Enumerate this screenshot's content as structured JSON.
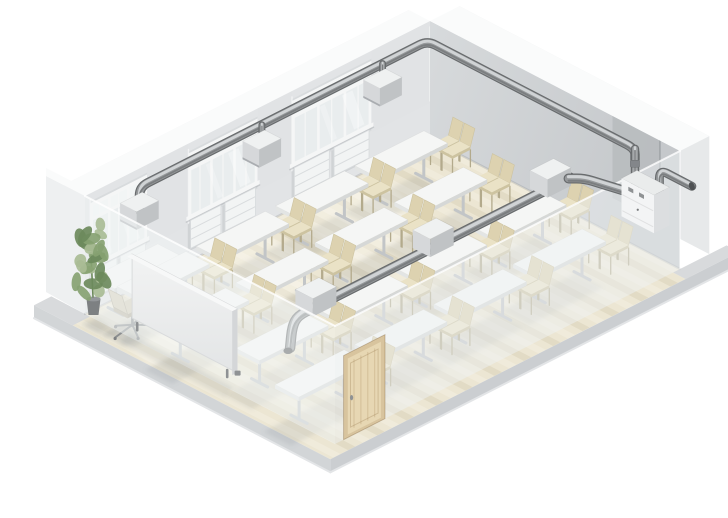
{
  "scene": {
    "description": "3D cutaway illustration of a classroom with a mechanical ventilation system: perimeter supply duct at ceiling level with drop diffusers above the windows, a mid-height extract duct with inline diffuser boxes crossing the room, and a wall-mounted ventilation unit with a pipe stub through the outside wall",
    "room": {
      "window_groups": 3,
      "windows_per_group": 3,
      "radiator_panels": 6
    },
    "ventilation": {
      "ceiling_drop_diffusers": 3,
      "inline_duct_diffusers": 3,
      "wall_units": 1,
      "outdoor_pipe_stubs": 1
    },
    "furniture": {
      "student_tables": 16,
      "student_chairs": 32,
      "teacher_desks": 1,
      "office_chairs": 1,
      "whiteboards": 1,
      "doors": 1,
      "plants": 1
    },
    "layout": {
      "table_rows_a": [
        0.09,
        0.32,
        0.55,
        0.78
      ],
      "table_cols_b": [
        0.1,
        0.32,
        0.575,
        0.795
      ],
      "stagger": 0.045,
      "window_groups_a": [
        [
          0.17,
          0.4
        ],
        [
          0.5,
          0.7
        ],
        [
          0.82,
          0.985
        ]
      ],
      "ceiling_diffusers_a": [
        0.875,
        0.52,
        0.17
      ],
      "inline_diffusers_a": [
        0.78,
        0.44,
        0.1
      ]
    }
  },
  "palette": {
    "background": "#ffffff",
    "floor": "#ece6d3",
    "floor_stripe_dark": "rgba(163,148,108,0.13)",
    "floor_stripe_light": "rgba(255,255,250,0.22)",
    "floor_light_pool": "rgba(255,255,252,0.30)",
    "slab_side_left": "#d2d5d7",
    "slab_side_right": "#cbced1",
    "slab_edge_light": "#e3e5e7",
    "slab_top": "#d8dadc",
    "wall_left": "#e2e4e6",
    "wall_left_band": "#d8dbdd",
    "wall_pillar": "#e1e3e5",
    "wall_right_a": "#d7dadc",
    "wall_right_b": "#c5c8cb",
    "wall_recess": "#b7babd",
    "wall_rim": "#fafbfb",
    "wall_outer_left": "#eef0f1",
    "wall_outer_right": "#e7e9ea",
    "window_frame": "#f5f6f6",
    "glass": "#e9edee",
    "glass_light": "#f2f5f5",
    "radiator": "#f2f4f4",
    "radiator_shade": "#d9dcde",
    "duct_body": "#96999b",
    "duct_dark": "#686b6d",
    "duct_light": "#d0d3d5",
    "duct_shade": "#7b7e80",
    "duct_cap": "#4e5153",
    "box_top": "#eff1f1",
    "box_front": "#d6d8da",
    "box_side": "#c0c3c5",
    "unit_top": "#eaecec",
    "unit_front": "#f3f4f5",
    "unit_side": "#dcdee0",
    "unit_detail": "#8f9294",
    "table_top": "#f5f6f5",
    "table_edge_front": "#e3e5e4",
    "table_edge_side": "#d6d8d7",
    "table_leg": "#c2c5c7",
    "chair_seat": "#eae2c6",
    "chair_back": "#ddd2b0",
    "chair_edge": "#cdc3a0",
    "chair_leg": "#b3aa8c",
    "board_face_a": "#f2f3f3",
    "board_face_b": "#e3e5e6",
    "board_edge": "#d4d6d8",
    "board_foot": "#8f9294",
    "door_frame": "#d8c49e",
    "door_leaf": "#e7d7b3",
    "door_grain": "rgba(160,130,82,0.28)",
    "door_handle": "#8e9193",
    "plant_green_1": "#a9bc95",
    "plant_green_2": "#87a272",
    "plant_green_3": "#6d8a5c",
    "plant_pot": "#7d8082",
    "office_chair_seat": "#d2ccb9",
    "office_chair_frame": "#8b8e90",
    "ghost_wall_left": "rgba(242,245,246,0.55)",
    "ghost_wall_right": "rgba(238,241,243,0.50)",
    "ghost_edge": "rgba(255,255,255,0.80)",
    "shadow": "rgba(115,120,126,0.14)",
    "ao": "rgba(110,115,122,0.26)"
  }
}
